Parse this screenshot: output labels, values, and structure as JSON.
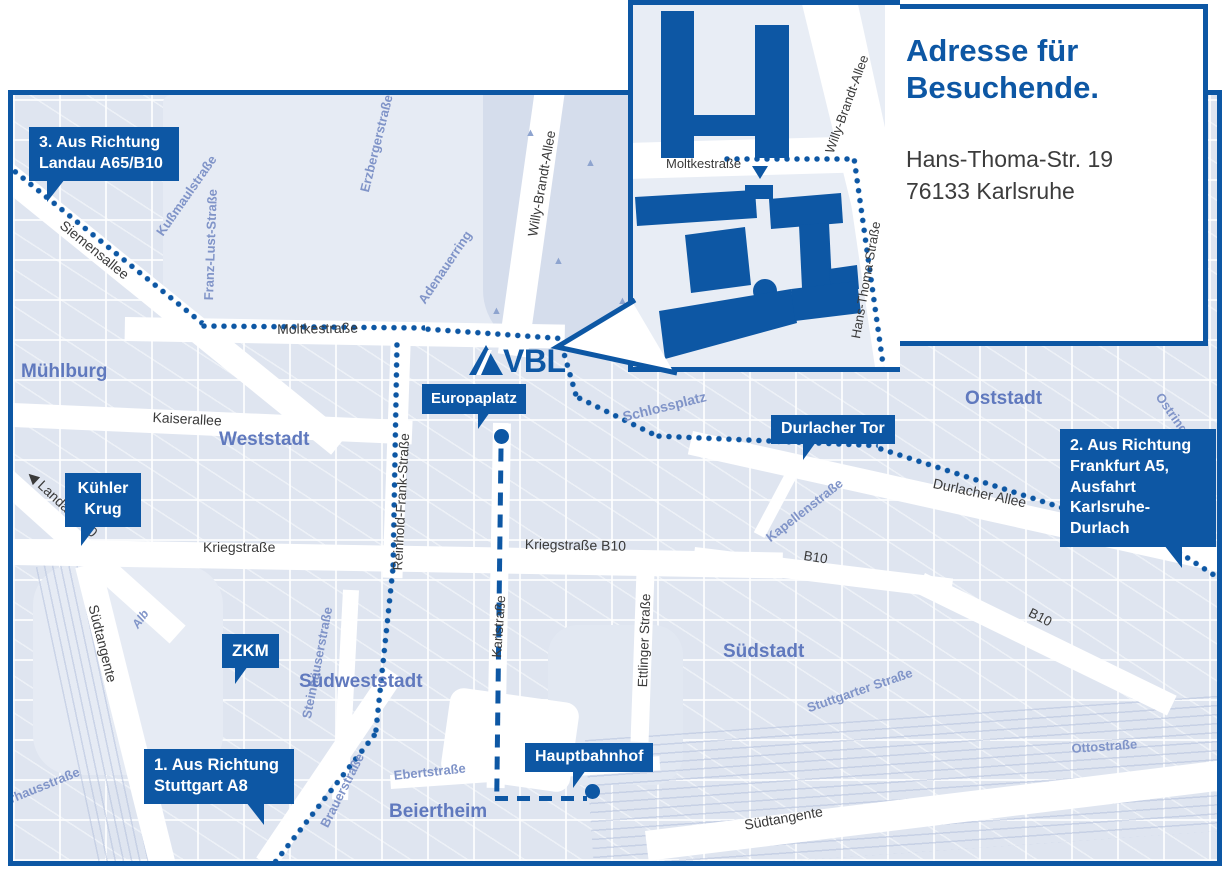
{
  "colors": {
    "accent": "#0d57a4",
    "map_background": "#dfe5f0",
    "district_label": "#6079be",
    "minor_street_label": "#8094c8",
    "street_label": "#3a3a3a",
    "address_text": "#3c3c3c"
  },
  "logo": {
    "text": "VBL"
  },
  "icons": {
    "tree": "▲",
    "direction_arrow": "◀"
  },
  "inset": {
    "title_line1": "Adresse für",
    "title_line2": "Besuchende.",
    "address_line1": "Hans-Thoma-Str. 19",
    "address_line2": "76133 Karlsruhe"
  },
  "badges": {
    "landau": {
      "lines": [
        "3. Aus Richtung",
        "Landau A65/B10"
      ]
    },
    "kuehler_krug": {
      "lines": [
        "Kühler",
        "Krug"
      ]
    },
    "zkm": {
      "lines": [
        "ZKM"
      ]
    },
    "europaplatz": {
      "lines": [
        "Europaplatz"
      ]
    },
    "durlacher_tor": {
      "lines": [
        "Durlacher Tor"
      ]
    },
    "hauptbahnhof": {
      "lines": [
        "Hauptbahnhof"
      ]
    },
    "stuttgart": {
      "lines": [
        "1. Aus Richtung",
        "Stuttgart A8"
      ]
    },
    "frankfurt": {
      "lines": [
        "2. Aus Richtung",
        "Frankfurt A5,",
        "Ausfahrt",
        "Karlsruhe-Durlach"
      ]
    }
  },
  "districts": {
    "muehlburg": "Mühlburg",
    "weststadt": "Weststadt",
    "oststadt": "Oststadt",
    "suedstadt": "Südstadt",
    "suedweststadt": "Südweststadt",
    "beiertheim": "Beiertheim"
  },
  "streets": {
    "siemensallee": "Siemensallee",
    "kussmaulstrasse": "Kußmaulstraße",
    "franz_lust_strasse": "Franz-Lust-Straße",
    "erzbergerstrasse": "Erzbergerstraße",
    "adenauerring": "Adenauerring",
    "willy_brandt_allee": "Willy-Brandt-Allee",
    "moltkestrasse": "Moltkestraße",
    "kaiserallee": "Kaiserallee",
    "reinhold_frank_strasse": "Reinhold-Frank-Straße",
    "schlossplatz": "Schlossplatz",
    "kapellenstrasse": "Kapellenstraße",
    "ostring": "Ostring",
    "durlacher_allee": "Durlacher Allee",
    "kriegstrasse": "Kriegstraße",
    "kriegstrasse_b10": "Kriegstraße B10",
    "b10": "B10",
    "landau_b10": "Landau B10",
    "karlstrasse": "Karlstraße",
    "ettlinger_strasse": "Ettlinger Straße",
    "stuttgarter_strasse": "Stuttgarter Straße",
    "steinhaeuserstrasse": "Steinhäuserstraße",
    "ebertstrasse": "Ebertstraße",
    "brauerstrasse": "Brauerstraße",
    "suedtangente": "Südtangente",
    "ottostrasse": "Ottostraße",
    "pulverhausstrasse": "Pulverhausstraße",
    "alb": "Alb",
    "hans_thoma_strasse": "Hans-Thoma-Straße"
  }
}
